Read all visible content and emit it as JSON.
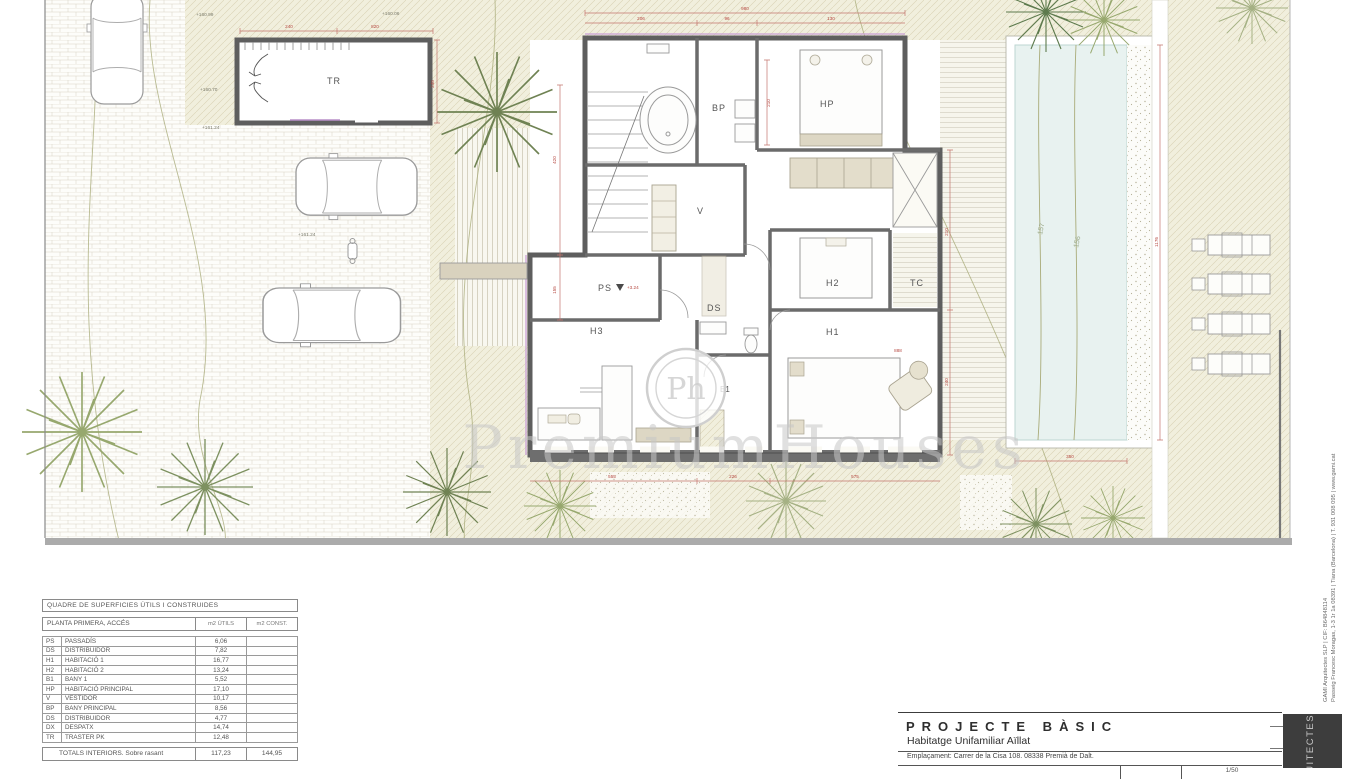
{
  "sheet": {
    "watermark": "PremiumHouses",
    "watermark_glyph": "Ph",
    "rooms": {
      "tr": "TR",
      "bp": "BP",
      "hp": "HP",
      "v": "V",
      "ps": "PS",
      "ds": "DS",
      "h2": "H2",
      "tc": "TC",
      "h3": "H3",
      "h1": "H1",
      "b1": "B1"
    },
    "levels": {
      "ps_level": "+3.24"
    },
    "elevations": {
      "e1": "+160.99",
      "e2": "+160.70",
      "e3": "+161.24",
      "e4": "+160.06",
      "e5": "+161.24"
    },
    "contours": {
      "c1": "157",
      "c2": "156"
    },
    "dims": [
      {
        "t": "240",
        "x": 289,
        "y": 28,
        "r": 0
      },
      {
        "t": "820",
        "x": 375,
        "y": 28,
        "r": 0
      },
      {
        "t": "980",
        "x": 745,
        "y": 10,
        "r": 0
      },
      {
        "t": "206",
        "x": 641,
        "y": 20,
        "r": 0
      },
      {
        "t": "96",
        "x": 727,
        "y": 20,
        "r": 0
      },
      {
        "t": "130",
        "x": 831,
        "y": 20,
        "r": 0
      },
      {
        "t": "420",
        "x": 556,
        "y": 160,
        "r": -90
      },
      {
        "t": "155",
        "x": 556,
        "y": 290,
        "r": -90
      },
      {
        "t": "248",
        "x": 434,
        "y": 84,
        "r": -90
      },
      {
        "t": "210",
        "x": 948,
        "y": 232,
        "r": -90
      },
      {
        "t": "240",
        "x": 948,
        "y": 382,
        "r": -90
      },
      {
        "t": "1176",
        "x": 1158,
        "y": 242,
        "r": -90
      },
      {
        "t": "555",
        "x": 612,
        "y": 478,
        "r": 0
      },
      {
        "t": "226",
        "x": 733,
        "y": 478,
        "r": 0
      },
      {
        "t": "575",
        "x": 855,
        "y": 478,
        "r": 0
      },
      {
        "t": "350",
        "x": 1070,
        "y": 458,
        "r": 0
      },
      {
        "t": "210",
        "x": 770,
        "y": 103,
        "r": -90
      },
      {
        "t": "888",
        "x": 898,
        "y": 352,
        "r": 0
      }
    ]
  },
  "areas_table": {
    "title": "QUADRE DE SUPERFICIES ÚTILS I CONSTRUIDES",
    "section": "PLANTA PRIMERA, ACCÉS",
    "col_utils": "m2 ÚTILS",
    "col_const": "m2 CONST.",
    "rows": [
      [
        "PS",
        "PASSADÍS",
        "6,06"
      ],
      [
        "DS",
        "DISTRIBUIDOR",
        "7,82"
      ],
      [
        "H1",
        "HABITACIÓ 1",
        "16,77"
      ],
      [
        "H2",
        "HABITACIÓ 2",
        "13,24"
      ],
      [
        "B1",
        "BANY 1",
        "5,52"
      ],
      [
        "HP",
        "HABITACIÓ PRINCIPAL",
        "17,10"
      ],
      [
        "V",
        "VESTIDOR",
        "10,17"
      ],
      [
        "BP",
        "BANY PRINCIPAL",
        "8,56"
      ],
      [
        "DS",
        "DISTRIBUIDOR",
        "4,77"
      ],
      [
        "DX",
        "DESPATX",
        "14,74"
      ],
      [
        "TR",
        "TRASTER PK",
        "12,48"
      ]
    ],
    "total_label": "TOTALS INTERIORS. Sobre rasant",
    "total_utils": "117,23",
    "total_const": "144,95"
  },
  "titleblock": {
    "title": "PROJECTE BÀSIC",
    "subtitle": "Habitatge Unifamiliar Aïllat",
    "location": "Emplaçament: Carrer de la Cisa 108. 08338 Premià de Dalt.",
    "scale": "1/50"
  },
  "credit": {
    "line1": "GAMI Arquitectes SLP | CIF: B64848114",
    "line2": "Passeig Francesc Moragas, 1-3 1r 1a 08391 | Tiana (Barcelona) | T. 931 008 095 | www.gami.cat"
  },
  "brand_box": {
    "label": "ARQUITECTES"
  },
  "colors": {
    "dimension_red": "#b5463f",
    "accent_magenta": "#c99fd6",
    "wall_gray": "#5e5e5e",
    "pool_water": "#e8f2f0",
    "hatch_cream": "#f1efdd",
    "brand_box_bg": "#3d3d3d"
  }
}
